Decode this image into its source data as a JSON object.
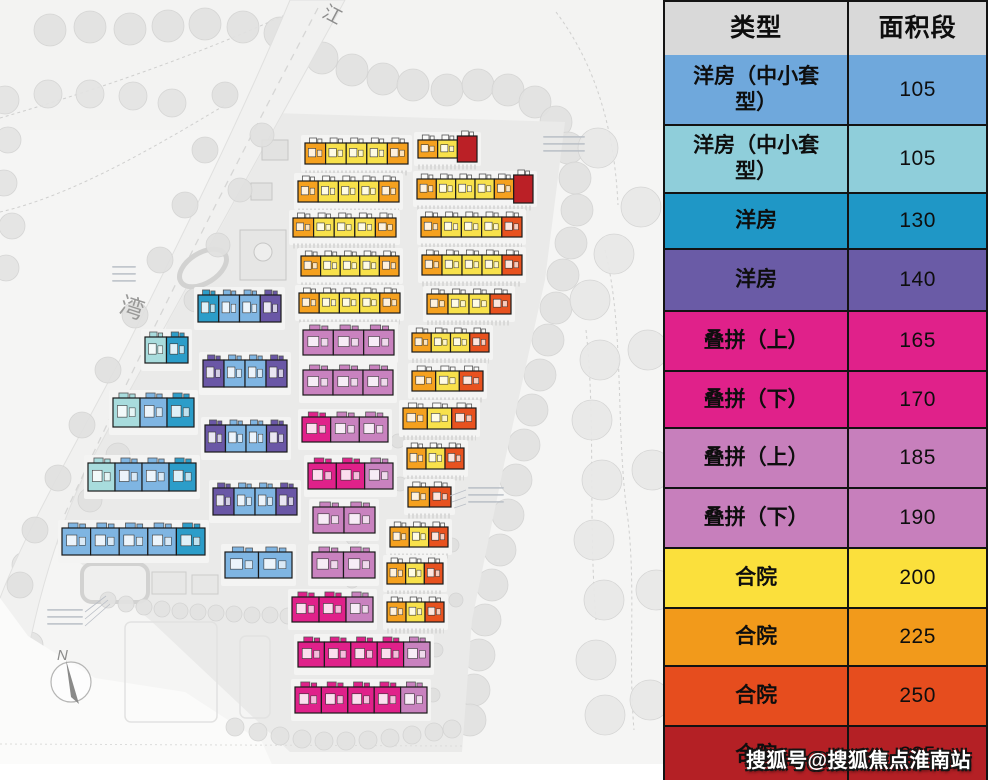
{
  "legend_table": {
    "headers": [
      "类型",
      "面积段"
    ],
    "rows": [
      {
        "type": "洋房（中小套型）",
        "area": "105",
        "color": "#6FA8DC"
      },
      {
        "type": "洋房（中小套型）",
        "area": "105",
        "color": "#8FCEDA"
      },
      {
        "type": "洋房",
        "area": "130",
        "color": "#1F97C6"
      },
      {
        "type": "洋房",
        "area": "140",
        "color": "#6A5BA6"
      },
      {
        "type": "叠拼（上）",
        "area": "165",
        "color": "#E0218A"
      },
      {
        "type": "叠拼（下）",
        "area": "170",
        "color": "#E0218A"
      },
      {
        "type": "叠拼（上）",
        "area": "185",
        "color": "#C77FBC"
      },
      {
        "type": "叠拼（下）",
        "area": "190",
        "color": "#C77FBC"
      },
      {
        "type": "合院",
        "area": "200",
        "color": "#FBE03C"
      },
      {
        "type": "合院",
        "area": "225",
        "color": "#F29A1B"
      },
      {
        "type": "合院",
        "area": "250",
        "color": "#E64D1E"
      },
      {
        "type": "合院",
        "area": "285",
        "color": "#B42025"
      }
    ]
  },
  "map": {
    "labels": {
      "river_top": "江",
      "river_left": "湾",
      "compass": "N"
    },
    "palette": {
      "Y": "#F8E14B",
      "O": "#F5A11F",
      "R": "#E8521F",
      "D": "#BB2026",
      "M": "#E0218A",
      "P": "#C982BF",
      "B": "#7FB5E2",
      "C": "#A8DCDD",
      "T": "#2C9DC9",
      "V": "#6A57A6"
    },
    "buildings": [
      {
        "x": 305,
        "y": 143,
        "w": 103,
        "h": 21,
        "u": "OYYYO"
      },
      {
        "x": 298,
        "y": 181,
        "w": 101,
        "h": 21,
        "u": "OYYYO"
      },
      {
        "x": 293,
        "y": 218,
        "w": 103,
        "h": 19,
        "u": "OYYYO"
      },
      {
        "x": 301,
        "y": 256,
        "w": 98,
        "h": 20,
        "u": "OYYYO"
      },
      {
        "x": 299,
        "y": 293,
        "w": 101,
        "h": 20,
        "u": "OYYYO"
      },
      {
        "x": 418,
        "y": 140,
        "w": 59,
        "h": 18,
        "u": "OYD",
        "tl": true
      },
      {
        "x": 417,
        "y": 179,
        "w": 116,
        "h": 20,
        "u": "OYYYOD",
        "tl": true
      },
      {
        "x": 421,
        "y": 217,
        "w": 101,
        "h": 20,
        "u": "OYYYR"
      },
      {
        "x": 422,
        "y": 255,
        "w": 100,
        "h": 20,
        "u": "OYYYR"
      },
      {
        "x": 427,
        "y": 294,
        "w": 84,
        "h": 20,
        "u": "OYYR"
      },
      {
        "x": 412,
        "y": 333,
        "w": 77,
        "h": 19,
        "u": "OYYR"
      },
      {
        "x": 412,
        "y": 371,
        "w": 71,
        "h": 20,
        "u": "OYR"
      },
      {
        "x": 403,
        "y": 408,
        "w": 73,
        "h": 21,
        "u": "OYR"
      },
      {
        "x": 407,
        "y": 448,
        "w": 57,
        "h": 21,
        "u": "OYR"
      },
      {
        "x": 408,
        "y": 487,
        "w": 43,
        "h": 20,
        "u": "OR"
      },
      {
        "x": 390,
        "y": 527,
        "w": 58,
        "h": 20,
        "u": "OYR"
      },
      {
        "x": 387,
        "y": 563,
        "w": 56,
        "h": 21,
        "u": "OYR"
      },
      {
        "x": 387,
        "y": 602,
        "w": 57,
        "h": 20,
        "u": "OYR"
      },
      {
        "x": 303,
        "y": 330,
        "w": 91,
        "h": 25,
        "u": "PPP"
      },
      {
        "x": 303,
        "y": 370,
        "w": 90,
        "h": 25,
        "u": "PPP"
      },
      {
        "x": 302,
        "y": 417,
        "w": 86,
        "h": 25,
        "u": "MPP"
      },
      {
        "x": 308,
        "y": 463,
        "w": 85,
        "h": 26,
        "u": "MMP"
      },
      {
        "x": 313,
        "y": 507,
        "w": 62,
        "h": 26,
        "u": "PP"
      },
      {
        "x": 312,
        "y": 552,
        "w": 63,
        "h": 26,
        "u": "PP"
      },
      {
        "x": 292,
        "y": 597,
        "w": 81,
        "h": 25,
        "u": "MMP"
      },
      {
        "x": 298,
        "y": 642,
        "w": 132,
        "h": 25,
        "u": "MMMMP"
      },
      {
        "x": 295,
        "y": 687,
        "w": 132,
        "h": 26,
        "u": "MMMMP"
      },
      {
        "x": 145,
        "y": 337,
        "w": 43,
        "h": 26,
        "u": "CT"
      },
      {
        "x": 113,
        "y": 398,
        "w": 81,
        "h": 29,
        "u": "CBT"
      },
      {
        "x": 88,
        "y": 463,
        "w": 108,
        "h": 28,
        "u": "CBBT"
      },
      {
        "x": 62,
        "y": 528,
        "w": 143,
        "h": 27,
        "u": "BBBBT"
      },
      {
        "x": 198,
        "y": 295,
        "w": 83,
        "h": 27,
        "u": "TBBV"
      },
      {
        "x": 203,
        "y": 360,
        "w": 84,
        "h": 27,
        "u": "VBBV"
      },
      {
        "x": 205,
        "y": 425,
        "w": 82,
        "h": 27,
        "u": "VBBV"
      },
      {
        "x": 213,
        "y": 488,
        "w": 84,
        "h": 27,
        "u": "VBBV"
      },
      {
        "x": 225,
        "y": 552,
        "w": 67,
        "h": 26,
        "u": "BB"
      }
    ]
  },
  "watermark": "搜狐号@搜狐焦点淮南站"
}
